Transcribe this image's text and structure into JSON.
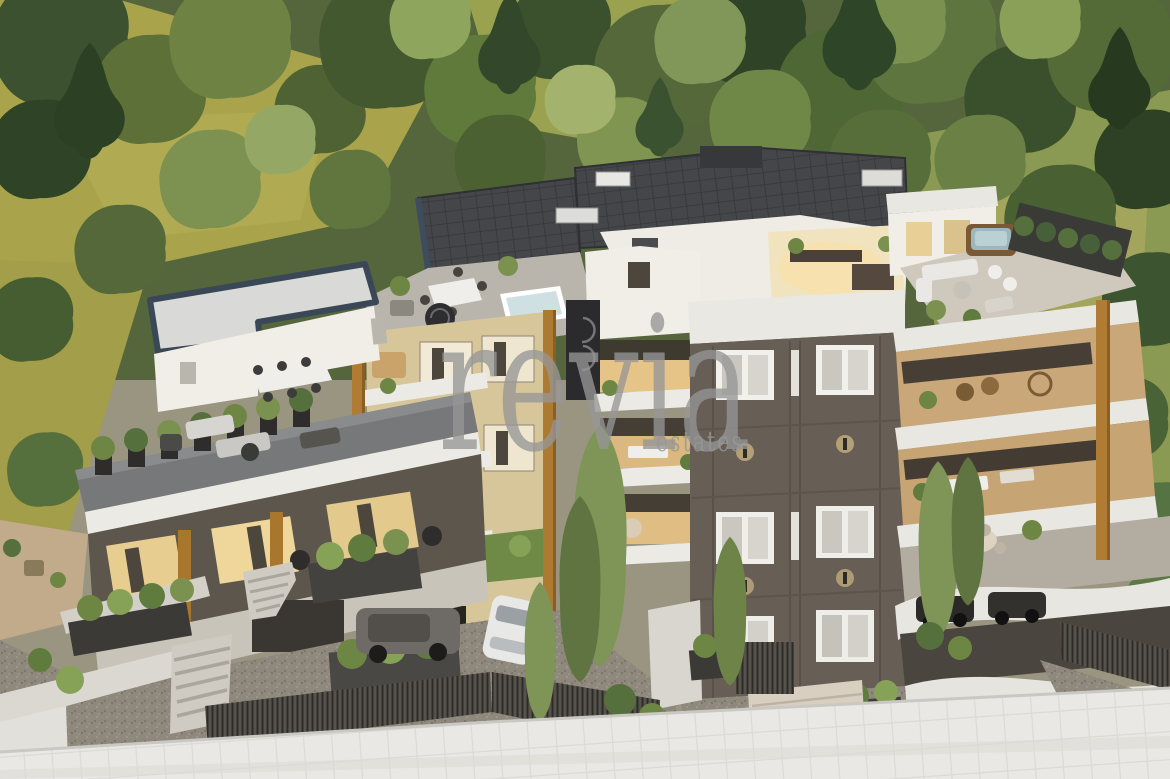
{
  "meta": {
    "type": "3D architectural rendering",
    "subject": "Aerial rendering of a modern multi-block apartment complex on a wooded hillside, with roof terraces, balconies, planted terraces, gravel driveways, parked cars and a street in the foreground"
  },
  "watermark": {
    "primary": "revia",
    "secondary": "estates",
    "color": "#969696"
  },
  "palette": {
    "forest_dark": "#2f4426",
    "forest_mid": "#54683a",
    "forest_light": "#8ba05a",
    "meadow_olive": "#a9a44b",
    "wall_white": "#efece5",
    "roof_panel_dark": "#46474b",
    "roof_trim_navy": "#3e4c5e",
    "wood_accent": "#ad7a32",
    "facade_dark_taupe": "#675e55",
    "facade_tan": "#d8c69b",
    "deck_gray": "#77787a",
    "gravel": "#8d867b",
    "road": "#e9e8e4",
    "interior_glow": "#f0d9a0",
    "pool_water": "#9fb6bd"
  }
}
